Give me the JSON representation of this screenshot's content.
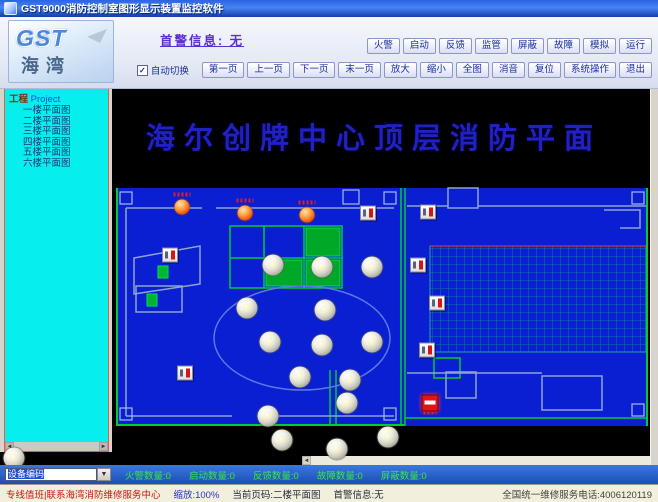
{
  "window": {
    "title": "GST9000消防控制室图形显示装置监控软件"
  },
  "header": {
    "logo_gst": "GST",
    "logo_haiwan": "海湾",
    "first_alarm_link": "首警信息: 无",
    "auto_switch_label": "自动切换",
    "auto_switch_checked": "✓",
    "state_buttons": [
      "火警",
      "启动",
      "反馈",
      "监管",
      "屏蔽",
      "故障",
      "模拟",
      "运行"
    ],
    "nav_buttons": [
      "第一页",
      "上一页",
      "下一页",
      "末一页",
      "放大",
      "缩小",
      "全图",
      "消音",
      "复位",
      "系统操作",
      "退出"
    ]
  },
  "sidebar": {
    "root_cn": "工程",
    "root_en": "Project",
    "items": [
      "一楼平面图",
      "二楼平面图",
      "三楼平面图",
      "四楼平面图",
      "五楼平面图",
      "六楼平面图"
    ]
  },
  "plan": {
    "title": "海尔创牌中心顶层消防平面",
    "colors": {
      "floor_blue": "#0a1ed2",
      "wall_green": "#00cc33",
      "wall_gray": "#8fa4d4",
      "grid_teal": "#0c8c8c"
    },
    "devices": [
      {
        "type": "sounder",
        "x": 182,
        "y": 207
      },
      {
        "type": "sounder",
        "x": 245,
        "y": 213
      },
      {
        "type": "sounder",
        "x": 307,
        "y": 215
      },
      {
        "type": "callpoint",
        "x": 368,
        "y": 213
      },
      {
        "type": "callpoint",
        "x": 428,
        "y": 212
      },
      {
        "type": "callpoint",
        "x": 418,
        "y": 265
      },
      {
        "type": "callpoint",
        "x": 437,
        "y": 303
      },
      {
        "type": "callpoint",
        "x": 427,
        "y": 350
      },
      {
        "type": "callpoint",
        "x": 170,
        "y": 255
      },
      {
        "type": "callpoint",
        "x": 185,
        "y": 373
      },
      {
        "type": "alarm",
        "x": 430,
        "y": 403
      },
      {
        "type": "green-equip",
        "x": 163,
        "y": 272
      },
      {
        "type": "green-equip",
        "x": 152,
        "y": 300
      },
      {
        "type": "detector",
        "x": 273,
        "y": 265
      },
      {
        "type": "detector",
        "x": 322,
        "y": 267
      },
      {
        "type": "detector",
        "x": 372,
        "y": 267
      },
      {
        "type": "detector",
        "x": 247,
        "y": 308
      },
      {
        "type": "detector",
        "x": 325,
        "y": 310
      },
      {
        "type": "detector",
        "x": 270,
        "y": 342
      },
      {
        "type": "detector",
        "x": 322,
        "y": 345
      },
      {
        "type": "detector",
        "x": 372,
        "y": 342
      },
      {
        "type": "detector",
        "x": 300,
        "y": 377
      },
      {
        "type": "detector",
        "x": 350,
        "y": 380
      },
      {
        "type": "detector",
        "x": 347,
        "y": 403
      },
      {
        "type": "detector",
        "x": 268,
        "y": 416
      },
      {
        "type": "detector",
        "x": 282,
        "y": 440
      },
      {
        "type": "detector",
        "x": 388,
        "y": 437
      },
      {
        "type": "detector",
        "x": 337,
        "y": 449
      },
      {
        "type": "detector",
        "x": 14,
        "y": 458
      }
    ]
  },
  "infobar": {
    "combo_value": "设备编码",
    "combo_arrow": "▼",
    "counters": [
      {
        "label": "火警数量",
        "value": "0"
      },
      {
        "label": "启动数量",
        "value": "0"
      },
      {
        "label": "反馈数量",
        "value": "0"
      },
      {
        "label": "故障数量",
        "value": "0"
      },
      {
        "label": "屏蔽数量",
        "value": "0"
      }
    ]
  },
  "statusbar": {
    "notice": "专线值班|联系海湾消防维修服务中心",
    "zoom": "缩放:100%",
    "page": "当前页码:二楼平面图",
    "first_alarm": "首警信息:无",
    "service": "全国统一维修服务电话:4006120119"
  }
}
